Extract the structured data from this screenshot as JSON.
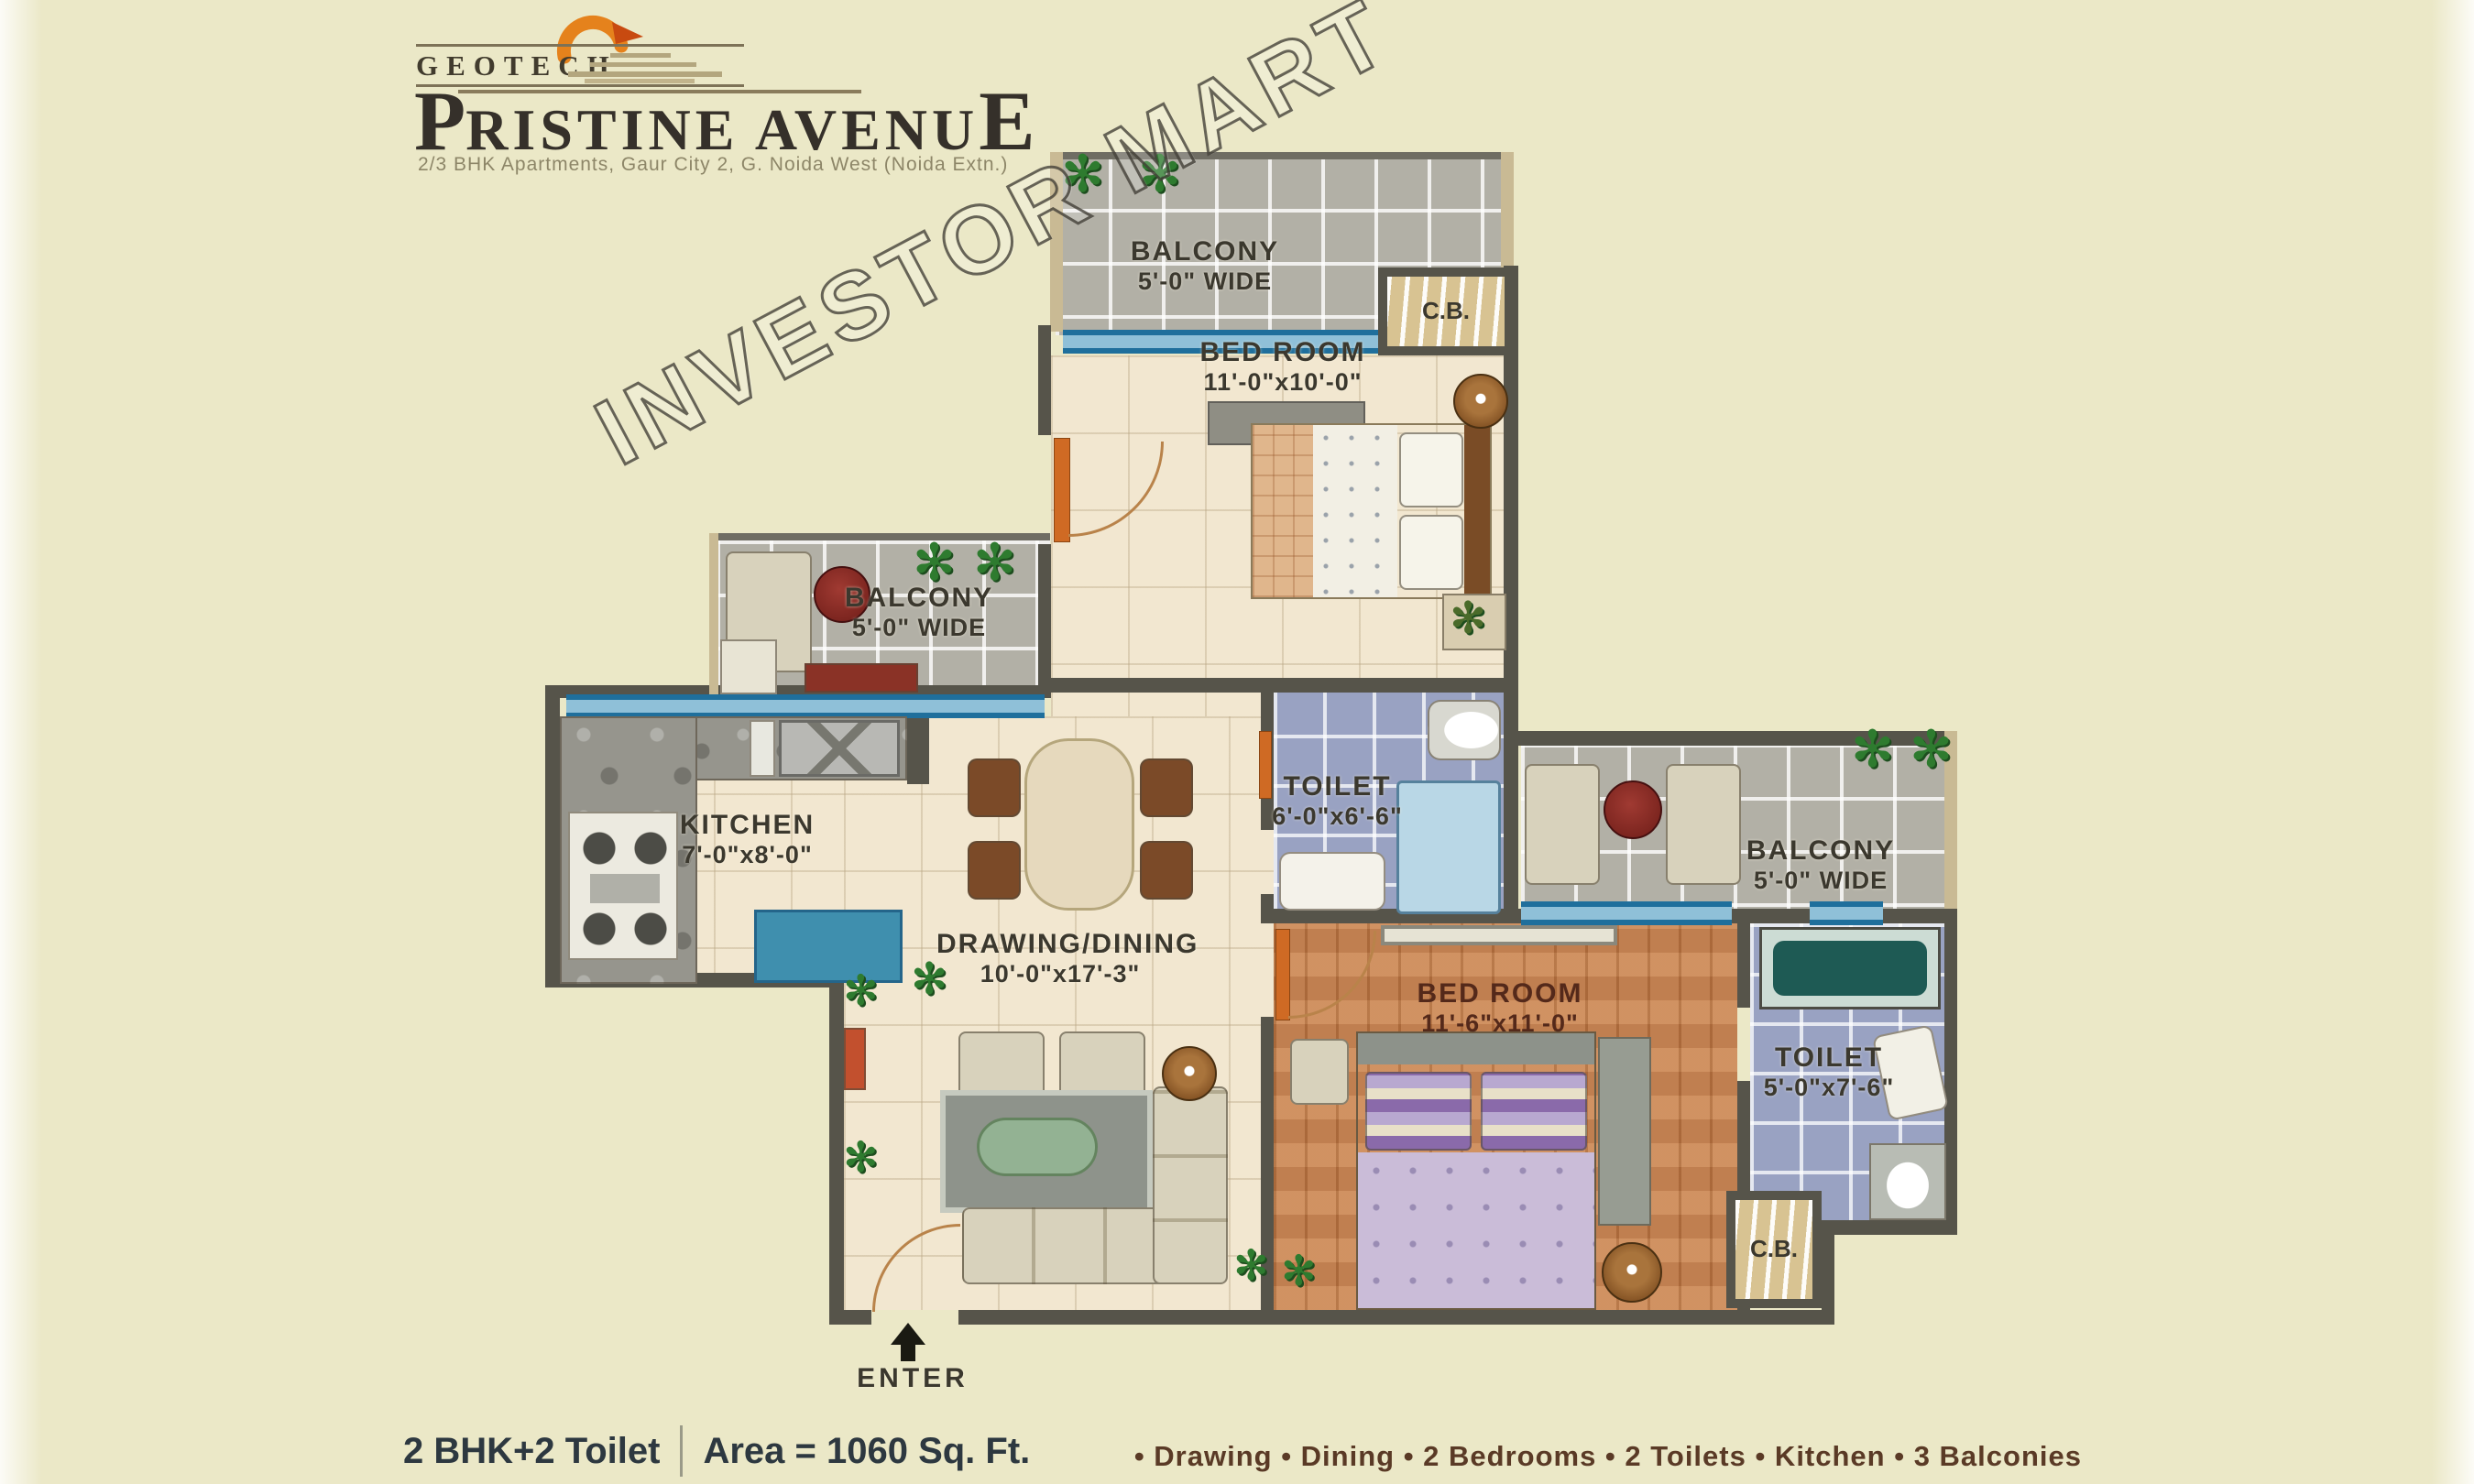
{
  "brand": {
    "logo": "GEOTECH",
    "title_parts": [
      "P",
      "RISTINE AVENU",
      "E"
    ],
    "subtitle": "2/3 BHK Apartments, Gaur City 2, G. Noida West (Noida Extn.)"
  },
  "watermark": "INVESTOR MART",
  "rooms": {
    "balcony_top": {
      "line1": "BALCONY",
      "line2": "5'-0\" WIDE"
    },
    "bedroom1": {
      "line1": "BED ROOM",
      "line2": "11'-0\"x10'-0\""
    },
    "balcony_left": {
      "line1": "BALCONY",
      "line2": "5'-0\" WIDE"
    },
    "kitchen": {
      "line1": "KITCHEN",
      "line2": "7'-0\"x8'-0\""
    },
    "toilet1": {
      "line1": "TOILET",
      "line2": "6'-0\"x6'-6\""
    },
    "balcony_right": {
      "line1": "BALCONY",
      "line2": "5'-0\" WIDE"
    },
    "drawing_dining": {
      "line1": "DRAWING/DINING",
      "line2": "10'-0\"x17'-3\""
    },
    "bedroom2": {
      "line1": "BED ROOM",
      "line2": "11'-6\"x11'-0\""
    },
    "toilet2": {
      "line1": "TOILET",
      "line2": "5'-0\"x7'-6\""
    },
    "cb_top": {
      "label": "C.B."
    },
    "cb_bottom": {
      "label": "C.B."
    },
    "enter": {
      "label": "ENTER"
    }
  },
  "footer": {
    "config": "2 BHK+2 Toilet",
    "area": "Area = 1060 Sq. Ft.",
    "features": "• Drawing • Dining • 2 Bedrooms • 2 Toilets • Kitchen • 3 Balconies"
  },
  "icons": {
    "plant": "✻"
  },
  "colors": {
    "wall": "#56544a",
    "window_teal": "#1f6f9c",
    "tile_grey": "#b2b0a6",
    "tile_blue": "#99a2c2",
    "floor_cream": "#f2e7d0",
    "floor_wood": "#c57f4c",
    "cb_tan": "#d8c392",
    "background": "#ebe8c7"
  }
}
